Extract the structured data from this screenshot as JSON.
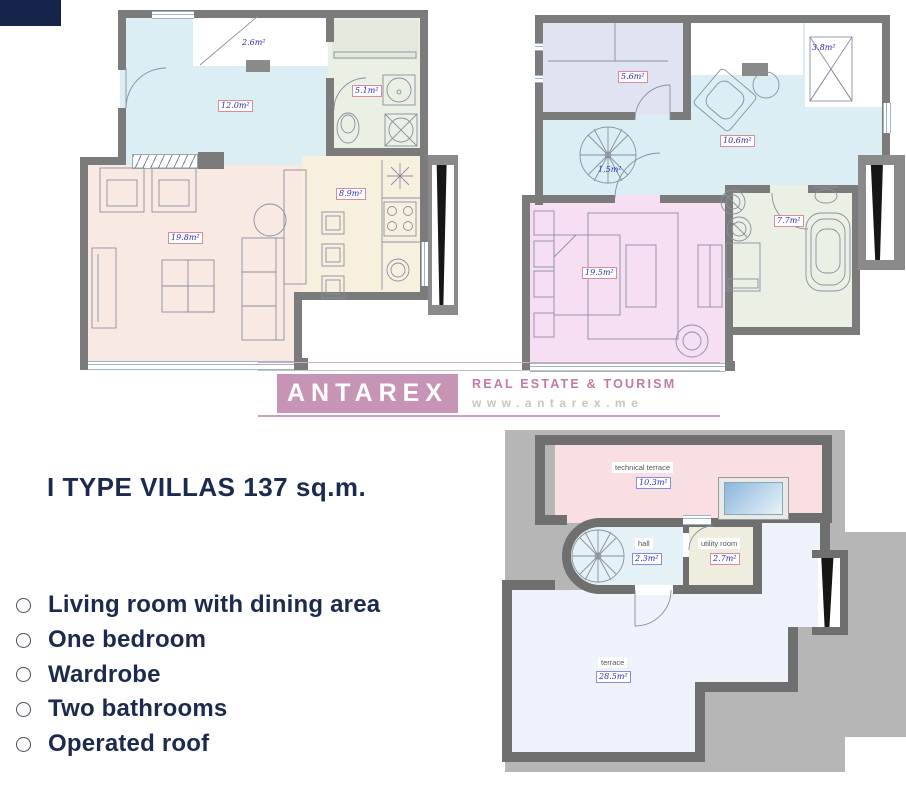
{
  "brand": {
    "name": "ANTAREX",
    "tagline": "REAL ESTATE & TOURISM",
    "url": "www.antarex.me",
    "block_color": "#c794b6"
  },
  "headline": {
    "title": "I TYPE VILLAS 137 sq.m."
  },
  "features": [
    "Living room with dining area",
    "One bedroom",
    "Wardrobe",
    "Two bathrooms",
    "Operated roof"
  ],
  "plans": {
    "ground": {
      "stairs": "2.6m²",
      "hall": "12.0m²",
      "bathroom": "5.1m²",
      "kitchen": "8.9m²",
      "living": "19.8m²"
    },
    "first": {
      "wardrobe": "5.6m²",
      "stairs": "3.8m²",
      "hall": "10.6m²",
      "spiral": "1.5m²",
      "bedroom": "19.5m²",
      "bathroom": "7.7m²"
    },
    "roof": {
      "technical_terrace": {
        "name": "technical terrace",
        "area": "10.3m²"
      },
      "hall": {
        "name": "hall",
        "area": "2.3m²"
      },
      "utility": {
        "name": "utility room",
        "area": "2.7m²"
      },
      "terrace": {
        "name": "terrace",
        "area": "28.5m²"
      }
    }
  },
  "colors": {
    "accent_navy": "#15234b",
    "wall_gray": "#7b7b7b",
    "hall_blue": "#daeef4",
    "living_pink": "#f8e9e3",
    "kitchen_beige": "#f8f0df",
    "bath_green": "#eaf0e3",
    "bedroom_pink": "#f6dff2",
    "wardrobe_lavender": "#e0e3f1",
    "roof_terrace": "#eef2fb",
    "technical_terrace_pink": "#f9dee2"
  }
}
